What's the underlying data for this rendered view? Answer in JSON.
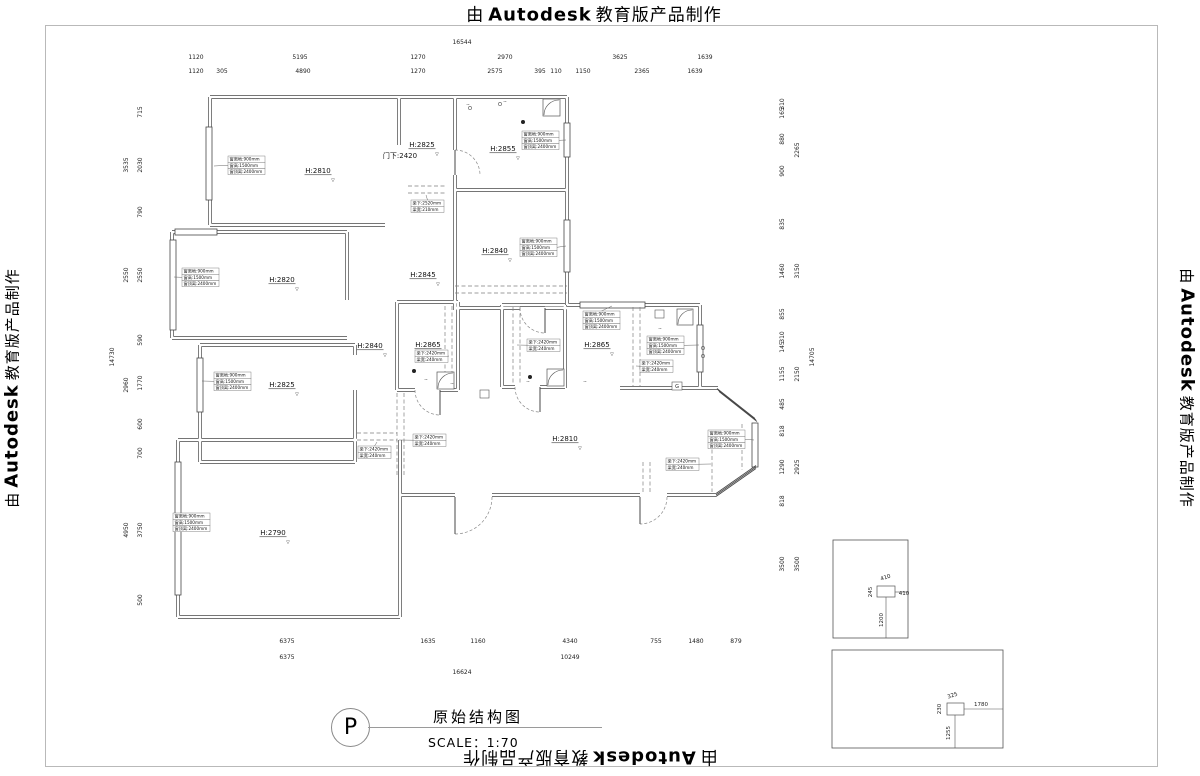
{
  "branding": {
    "prefix": "由",
    "brand": "Autodesk",
    "suffix": "教育版产品制作"
  },
  "title_block": {
    "symbol": "P",
    "title": "原始结构图",
    "scale": "SCALE：1:70"
  },
  "door_label": {
    "t": "门下:2420",
    "x": 400,
    "y": 158
  },
  "room_labels": [
    {
      "t": "H:2810",
      "x": 318,
      "y": 173
    },
    {
      "t": "H:2825",
      "x": 422,
      "y": 147
    },
    {
      "t": "H:2855",
      "x": 503,
      "y": 151
    },
    {
      "t": "H:2840",
      "x": 495,
      "y": 253
    },
    {
      "t": "H:2845",
      "x": 423,
      "y": 277
    },
    {
      "t": "H:2820",
      "x": 282,
      "y": 282
    },
    {
      "t": "H:2825",
      "x": 282,
      "y": 387
    },
    {
      "t": "H:2840",
      "x": 370,
      "y": 348
    },
    {
      "t": "H:2865",
      "x": 428,
      "y": 347
    },
    {
      "t": "H:2865",
      "x": 597,
      "y": 347
    },
    {
      "t": "H:2810",
      "x": 565,
      "y": 441
    },
    {
      "t": "H:2790",
      "x": 273,
      "y": 535
    }
  ],
  "annotation_texts": {
    "window": [
      "窗离地:900mm",
      "窗高:1500mm",
      "窗顶离:2400mm"
    ],
    "beam": [
      "梁下:2420mm",
      "梁宽:240mm"
    ],
    "beam2": [
      "梁下:2520mm",
      "梁宽:210mm"
    ]
  },
  "annotation_boxes": [
    {
      "x": 228,
      "y": 156,
      "k": "window",
      "t": [
        214,
        166
      ]
    },
    {
      "x": 411,
      "y": 200,
      "k": "beam2",
      "t": [
        426,
        195
      ]
    },
    {
      "x": 522,
      "y": 131,
      "k": "window",
      "t": [
        566,
        140
      ]
    },
    {
      "x": 520,
      "y": 238,
      "k": "window",
      "t": [
        566,
        246
      ]
    },
    {
      "x": 182,
      "y": 268,
      "k": "window",
      "t": [
        174,
        277
      ]
    },
    {
      "x": 214,
      "y": 372,
      "k": "window",
      "t": [
        202,
        381
      ]
    },
    {
      "x": 415,
      "y": 350,
      "k": "beam",
      "t": [
        449,
        356
      ]
    },
    {
      "x": 527,
      "y": 339,
      "k": "beam",
      "t": [
        517,
        345
      ]
    },
    {
      "x": 583,
      "y": 311,
      "k": "window",
      "t": [
        612,
        306
      ]
    },
    {
      "x": 647,
      "y": 336,
      "k": "window",
      "t": [
        699,
        345
      ]
    },
    {
      "x": 640,
      "y": 360,
      "k": "beam",
      "t": [
        636,
        366
      ]
    },
    {
      "x": 708,
      "y": 430,
      "k": "window",
      "t": [
        754,
        440
      ]
    },
    {
      "x": 666,
      "y": 458,
      "k": "beam",
      "t": [
        711,
        464
      ]
    },
    {
      "x": 173,
      "y": 513,
      "k": "window",
      "t": [
        177,
        521
      ]
    },
    {
      "x": 413,
      "y": 434,
      "k": "beam",
      "t": [
        399,
        440
      ]
    },
    {
      "x": 358,
      "y": 446,
      "k": "beam",
      "t": [
        377,
        442
      ]
    }
  ],
  "dim_lines": [
    {
      "id": "top-total",
      "o": "h",
      "c": 46,
      "from": 177,
      "to": 713,
      "labels": [
        [
          "16544",
          462
        ]
      ]
    },
    {
      "id": "top-row1",
      "o": "h",
      "c": 61,
      "from": 177,
      "to": 745,
      "labels": [
        [
          "1120",
          196
        ],
        [
          "5195",
          300
        ],
        [
          "1270",
          418
        ],
        [
          "2970",
          505
        ],
        [
          "3625",
          620
        ],
        [
          "1639",
          705
        ]
      ]
    },
    {
      "id": "top-row2",
      "o": "h",
      "c": 75,
      "from": 177,
      "to": 745,
      "labels": [
        [
          "1120",
          196
        ],
        [
          "305",
          222
        ],
        [
          "4890",
          303
        ],
        [
          "1270",
          418
        ],
        [
          "2575",
          495
        ],
        [
          "395",
          540
        ],
        [
          "110",
          556
        ],
        [
          "1150",
          583
        ],
        [
          "2365",
          642
        ],
        [
          "1639",
          695
        ]
      ]
    },
    {
      "id": "bottom-row1",
      "o": "h",
      "c": 645,
      "from": 177,
      "to": 748,
      "labels": [
        [
          "6375",
          287
        ],
        [
          "1635",
          428
        ],
        [
          "1160",
          478
        ],
        [
          "4340",
          570
        ],
        [
          "755",
          656
        ],
        [
          "1480",
          696
        ],
        [
          "879",
          736
        ]
      ]
    },
    {
      "id": "bottom-row2",
      "o": "h",
      "c": 661,
      "from": 177,
      "to": 748,
      "labels": [
        [
          "6375",
          287
        ],
        [
          "10249",
          570
        ]
      ]
    },
    {
      "id": "bottom-total",
      "o": "h",
      "c": 676,
      "from": 177,
      "to": 748,
      "labels": [
        [
          "16624",
          462
        ]
      ]
    },
    {
      "id": "left-total",
      "o": "v",
      "c": 116,
      "from": 100,
      "to": 615,
      "labels": [
        [
          "14730",
          357
        ]
      ]
    },
    {
      "id": "left-mid",
      "o": "v",
      "c": 130,
      "from": 100,
      "to": 615,
      "labels": [
        [
          "3535",
          165
        ],
        [
          "2550",
          275
        ],
        [
          "2960",
          385
        ],
        [
          "4950",
          530
        ]
      ]
    },
    {
      "id": "left-detail",
      "o": "v",
      "c": 144,
      "from": 100,
      "to": 615,
      "labels": [
        [
          "715",
          112
        ],
        [
          "2030",
          165
        ],
        [
          "790",
          212
        ],
        [
          "2550",
          275
        ],
        [
          "590",
          340
        ],
        [
          "1770",
          383
        ],
        [
          "600",
          424
        ],
        [
          "700",
          453
        ],
        [
          "3750",
          530
        ],
        [
          "500",
          600
        ]
      ]
    },
    {
      "id": "right-detail",
      "o": "v",
      "c": 786,
      "from": 100,
      "to": 612,
      "labels": [
        [
          "310",
          104
        ],
        [
          "165",
          113
        ],
        [
          "880",
          139
        ],
        [
          "900",
          171
        ],
        [
          "835",
          224
        ],
        [
          "1460",
          271
        ],
        [
          "855",
          314
        ],
        [
          "310",
          337
        ],
        [
          "145",
          347
        ],
        [
          "1155",
          374
        ],
        [
          "485",
          404
        ],
        [
          "818",
          431
        ],
        [
          "1290",
          467
        ],
        [
          "818",
          501
        ],
        [
          "3500",
          564
        ]
      ]
    },
    {
      "id": "right-mid",
      "o": "v",
      "c": 801,
      "from": 100,
      "to": 612,
      "labels": [
        [
          "2265",
          150
        ],
        [
          "3150",
          271
        ],
        [
          "2150",
          374
        ],
        [
          "2925",
          467
        ],
        [
          "3500",
          564
        ]
      ]
    },
    {
      "id": "right-total",
      "o": "v",
      "c": 816,
      "from": 100,
      "to": 612,
      "labels": [
        [
          "14705",
          357
        ]
      ]
    }
  ],
  "detail_figures": [
    {
      "rect": [
        833,
        540,
        75,
        98
      ],
      "box": [
        877,
        586,
        18,
        11
      ],
      "dims": [
        [
          "410",
          886,
          579,
          -18
        ],
        [
          "245",
          872,
          592,
          -90
        ],
        [
          "410",
          904,
          595,
          0
        ],
        [
          "1200",
          883,
          620,
          -90
        ]
      ],
      "leaders": [
        [
          886,
          597,
          886,
          638
        ],
        [
          895,
          592,
          908,
          592
        ]
      ]
    },
    {
      "rect": [
        832,
        650,
        171,
        98
      ],
      "box": [
        947,
        703,
        17,
        12
      ],
      "dims": [
        [
          "325",
          953,
          697,
          -18
        ],
        [
          "230",
          941,
          709,
          -90
        ],
        [
          "1780",
          981,
          706,
          0
        ],
        [
          "1255",
          950,
          733,
          -90
        ]
      ],
      "leaders": [
        [
          964,
          709,
          1003,
          709
        ],
        [
          955,
          715,
          955,
          748
        ]
      ]
    }
  ],
  "fixtures": {
    "gas_label": "G",
    "mark": "~",
    "elev_mark": "▽"
  }
}
